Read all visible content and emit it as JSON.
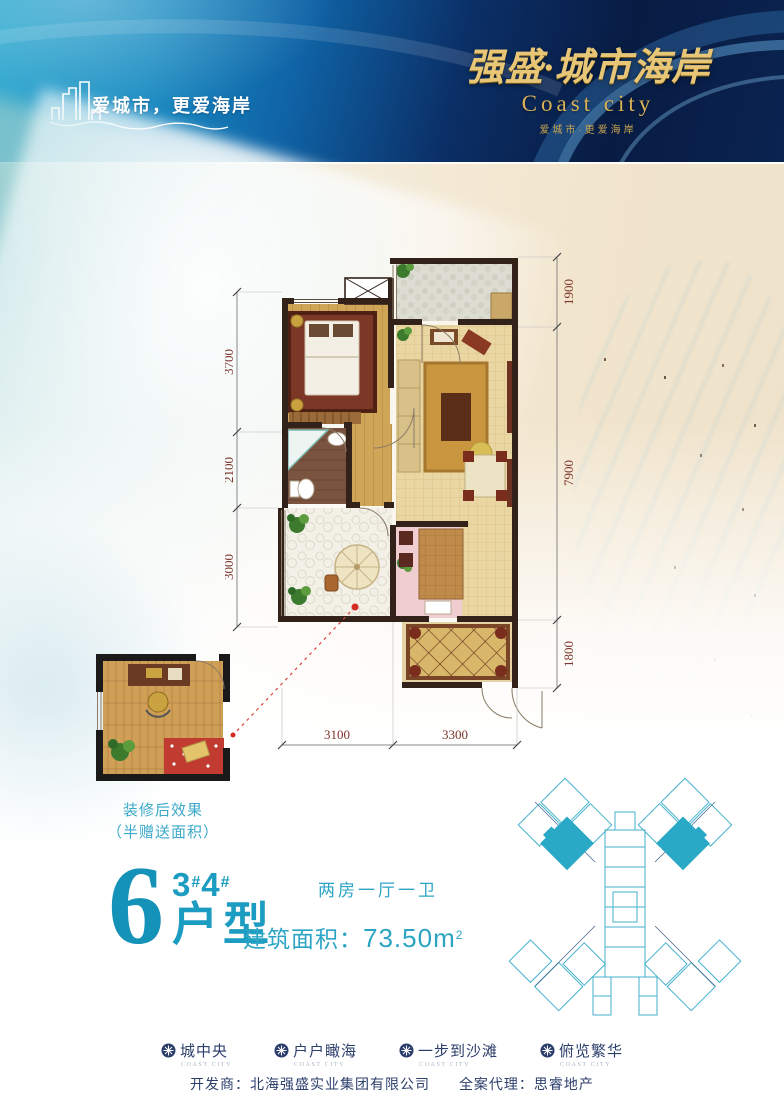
{
  "header": {
    "tagline": "爱城市，更爱海岸",
    "logo_cn": "强盛·城市海岸",
    "logo_en": "Coast city",
    "logo_sub": "爱城市·更爱海岸"
  },
  "plan": {
    "dims_left": [
      "3700",
      "2100",
      "3000"
    ],
    "dims_right": [
      "1900",
      "7900",
      "1800"
    ],
    "dims_bottom": [
      "3100",
      "3300"
    ]
  },
  "inset": {
    "caption1": "装修后效果",
    "caption2": "（半赠送面积）"
  },
  "unit": {
    "number": "6",
    "bld1": "3",
    "hash1": "#",
    "bld2": "4",
    "hash2": "#",
    "type_label": "户型",
    "rooms": "两房一厅一卫",
    "area_label": "建筑面积：",
    "area_value": "73.50m",
    "area_sup": "2"
  },
  "features": [
    {
      "label": "城中央",
      "sub": "COAST CITY"
    },
    {
      "label": "户户瞰海",
      "sub": "COAST CITY"
    },
    {
      "label": "一步到沙滩",
      "sub": "COAST CITY"
    },
    {
      "label": "俯览繁华",
      "sub": "COAST CITY"
    }
  ],
  "footer": {
    "developer": "开发商：北海强盛实业集团有限公司",
    "agency": "全案代理：思睿地产"
  },
  "colors": {
    "accent_teal": "#1b9cc0",
    "navy": "#2c3e6c",
    "gold": "#d9b258",
    "dim_text": "#7a342b",
    "site_highlight": "#29a9c6"
  }
}
